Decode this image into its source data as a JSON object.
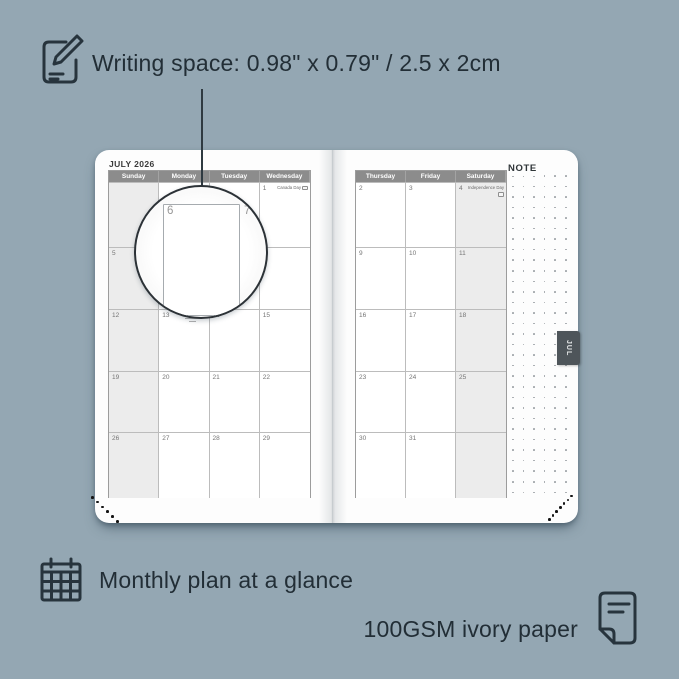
{
  "background_color": "#94a7b3",
  "ink_color": "#27343d",
  "annotations": {
    "writing_space": "Writing space: 0.98\" x 0.79\" / 2.5 x 2cm",
    "monthly_plan": "Monthly plan at a glance",
    "paper": "100GSM ivory paper"
  },
  "planner": {
    "month_title": "JULY 2026",
    "note_label": "NOTE",
    "tab_label": "JUL",
    "left_page": {
      "headers": [
        "Sunday",
        "Monday",
        "Tuesday",
        "Wednesday"
      ],
      "shaded_column": 0,
      "weeks": [
        [
          {
            "day": ""
          },
          {
            "day": ""
          },
          {
            "day": ""
          },
          {
            "day": "1",
            "holiday": "Canada Day",
            "flag": true
          }
        ],
        [
          {
            "day": "5"
          },
          {
            "day": "6"
          },
          {
            "day": "7"
          },
          {
            "day": "8"
          }
        ],
        [
          {
            "day": "12"
          },
          {
            "day": "13"
          },
          {
            "day": "14"
          },
          {
            "day": "15"
          }
        ],
        [
          {
            "day": "19"
          },
          {
            "day": "20"
          },
          {
            "day": "21"
          },
          {
            "day": "22"
          }
        ],
        [
          {
            "day": "26"
          },
          {
            "day": "27"
          },
          {
            "day": "28"
          },
          {
            "day": "29"
          }
        ]
      ]
    },
    "right_page": {
      "headers": [
        "Thursday",
        "Friday",
        "Saturday"
      ],
      "shaded_column": 2,
      "weeks": [
        [
          {
            "day": "2"
          },
          {
            "day": "3"
          },
          {
            "day": "4",
            "holiday": "Independence Day",
            "flag": true
          }
        ],
        [
          {
            "day": "9"
          },
          {
            "day": "10"
          },
          {
            "day": "11"
          }
        ],
        [
          {
            "day": "16"
          },
          {
            "day": "17"
          },
          {
            "day": "18"
          }
        ],
        [
          {
            "day": "23"
          },
          {
            "day": "24"
          },
          {
            "day": "25"
          }
        ],
        [
          {
            "day": "30"
          },
          {
            "day": "31"
          },
          {
            "day": ""
          }
        ]
      ]
    },
    "magnifier": {
      "large_day": "6",
      "adjacent_day": "7"
    },
    "note_grid": {
      "cols": 6,
      "rows": 31
    },
    "corner_dots": {
      "left": 6,
      "right": 7
    }
  },
  "colors": {
    "header_bg": "#8c8c8c",
    "shaded_cell": "#ececec",
    "grid_line": "#bcbcbc",
    "tab_bg": "#4e555a"
  }
}
